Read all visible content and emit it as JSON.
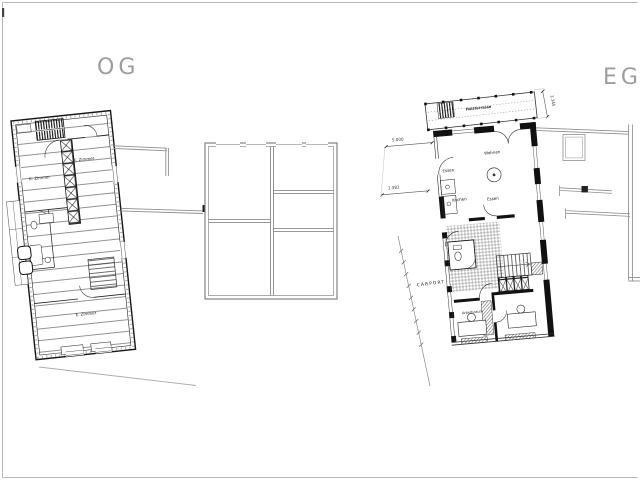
{
  "titles": {
    "og": "OG",
    "eg": "EG"
  },
  "og": {
    "rooms": [
      {
        "label": "K. Zimmer"
      },
      {
        "label": "K. Zimmer"
      },
      {
        "label": "E. Zimmer"
      }
    ]
  },
  "eg": {
    "rooms": [
      {
        "label": "Wohnen"
      },
      {
        "label": "Essen"
      },
      {
        "label": "Kochen"
      },
      {
        "label": "Essen"
      },
      {
        "label": "Arbeitsraum"
      },
      {
        "label": "Arbeitsraum"
      }
    ],
    "carport_label": "CARPORT",
    "deck_label": "Holzterrasse",
    "dimensions": {
      "width_top": "5.000",
      "width_mid": "1.382",
      "deck_depth": "2.345"
    }
  },
  "colors": {
    "paper": "#ffffff",
    "ink": "#111111",
    "gray_wall": "#8f8f8f",
    "title_gray": "#9c9c9c",
    "frame": "#b8b8b8"
  }
}
